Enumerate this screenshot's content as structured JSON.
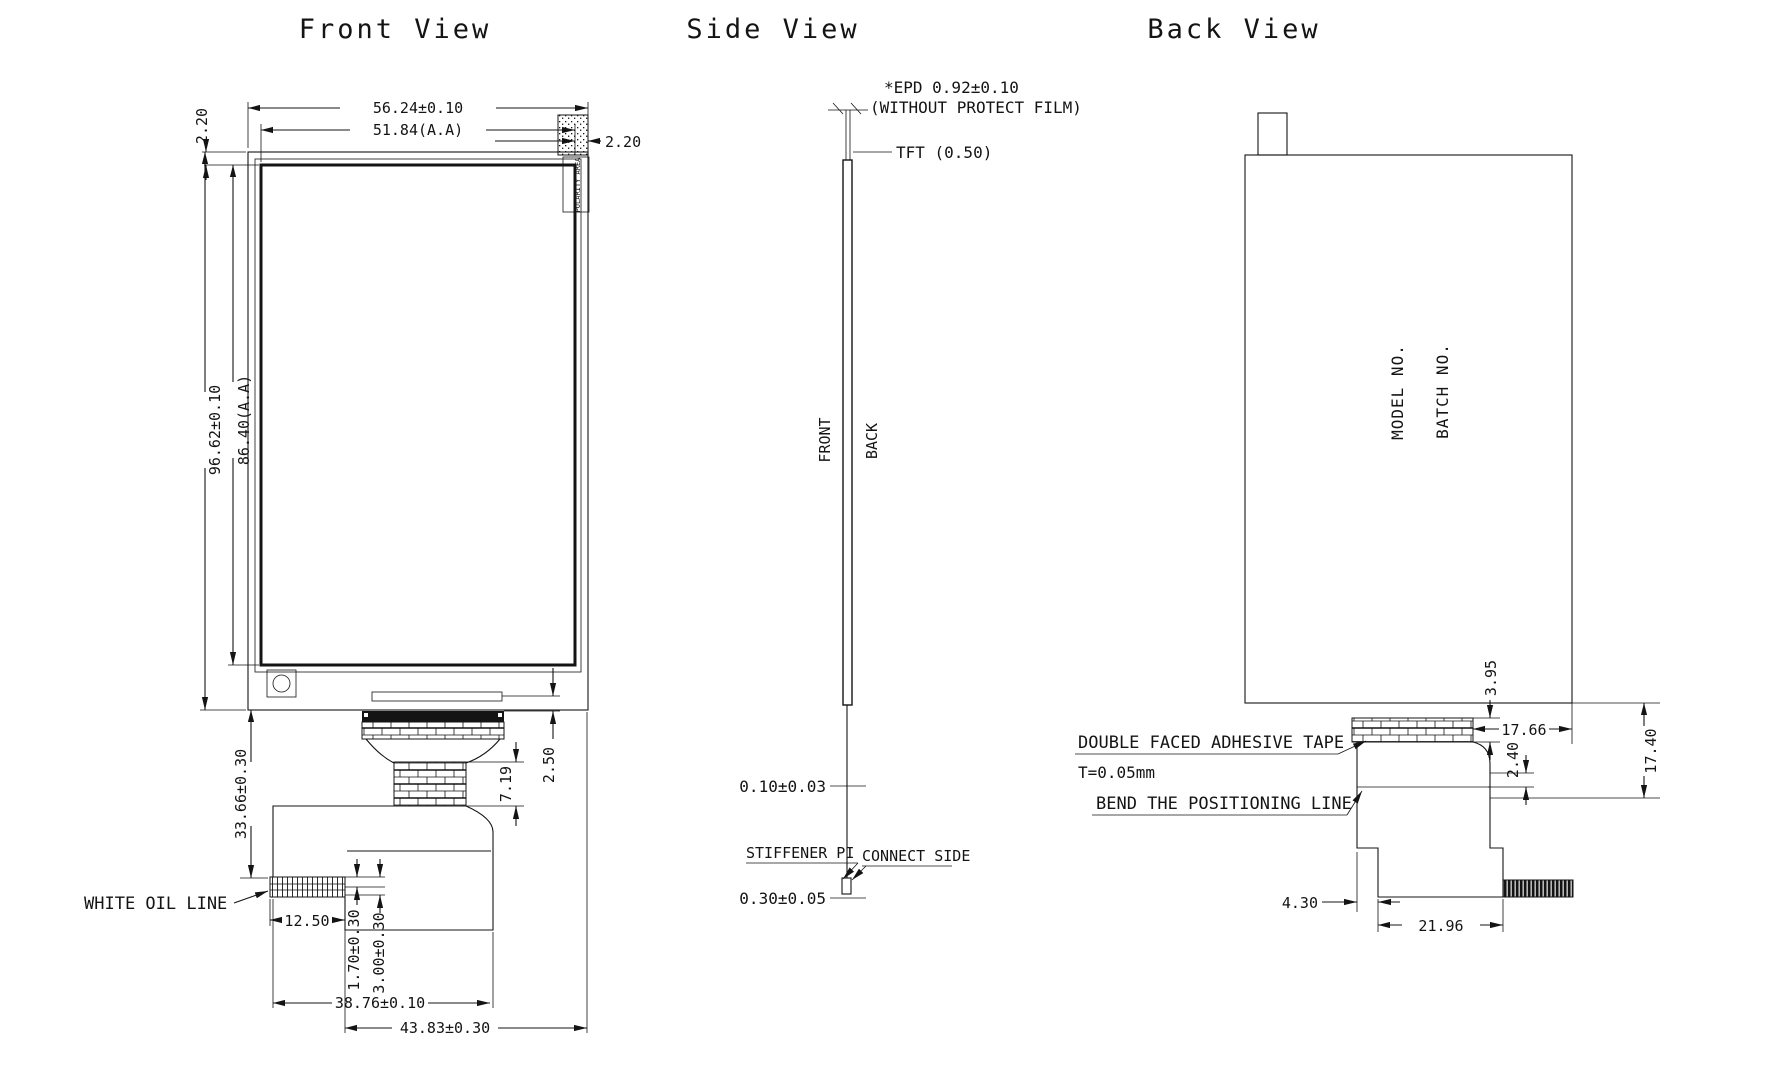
{
  "drawing": {
    "titles": {
      "front": "Front View",
      "side": "Side View",
      "back": "Back View"
    }
  },
  "front": {
    "overall_width": "56.24±0.10",
    "aa_width": "51.84(A.A)",
    "border_top": "2.20",
    "border_right": "2.20",
    "overall_height": "96.62±0.10",
    "aa_height": "86.40(A.A)",
    "fpc_length": "33.66±0.30",
    "bond_offset": "2.50",
    "bond_depth": "7.19",
    "tail_step_width": "12.50",
    "finger_dim_a": "1.70±0.30",
    "finger_dim_b": "3.00±0.30",
    "tail_width_a": "38.76±0.10",
    "tail_width_b": "43.83±0.30",
    "white_oil_line": "WHITE OIL LINE",
    "polarity_area": "POLARITY AREA"
  },
  "side": {
    "epd": "*EPD 0.92±0.10",
    "epd_note": "(WITHOUT PROTECT FILM)",
    "tft": "TFT (0.50)",
    "front_label": "FRONT",
    "back_label": "BACK",
    "film": "0.10±0.03",
    "stiffener_label": "STIFFENER PI",
    "connect_side": "CONNECT SIDE",
    "stiffener_dim": "0.30±0.05"
  },
  "back": {
    "model_no": "MODEL NO.",
    "batch_no": "BATCH NO.",
    "tape_label": "DOUBLE FACED ADHESIVE TAPE",
    "tape_t": "T=0.05mm",
    "bend_label": "BEND THE POSITIONING LINE",
    "dim_tape_h": "3.95",
    "dim_tape_edge": "17.66",
    "dim_bend": "2.40",
    "dim_drop": "17.40",
    "dim_step": "4.30",
    "dim_tail_w": "21.96"
  }
}
